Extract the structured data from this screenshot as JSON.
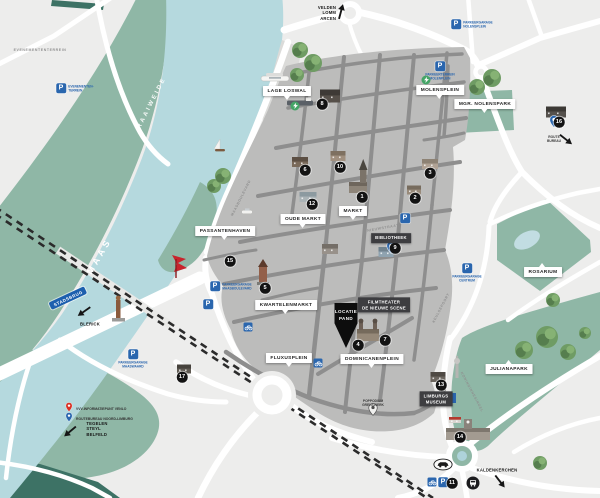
{
  "colors": {
    "water": "#b5d9de",
    "green": "#8fb7a6",
    "green_dark": "#3d7265",
    "city": "#bcbcbb",
    "street": "#8e8e8e",
    "road": "#ffffff",
    "bg": "#ededec",
    "marker": "#131313",
    "blue": "#2a66ae",
    "label_dark": "#3d3d40",
    "red_pin": "#d93025",
    "sculpture_red": "#c8242c"
  },
  "region_labels": [
    {
      "text": "RAAIWEIDE",
      "x": 152,
      "y": 103,
      "rot": -63,
      "size": 6,
      "ls": 2.5,
      "weight": "bold",
      "opacity": 0.95
    },
    {
      "text": "MAAS",
      "x": 99,
      "y": 256,
      "rot": -60,
      "size": 9,
      "ls": 3.5,
      "weight": "bold",
      "opacity": 1
    }
  ],
  "street_names": [
    {
      "text": "MAASBOULEVARD",
      "x": 241,
      "y": 198,
      "rot": -63
    },
    {
      "text": "NIEUWSTRAAT",
      "x": 383,
      "y": 228,
      "rot": -10
    },
    {
      "text": "KEULSEPOORT",
      "x": 441,
      "y": 308,
      "rot": -62
    },
    {
      "text": "KONINGINNESINGEL",
      "x": 472,
      "y": 392,
      "rot": 62
    },
    {
      "text": "EVENEMENTENTERREIN",
      "x": 40,
      "y": 50,
      "rot": 0
    }
  ],
  "place_labels": [
    {
      "text": "LAGE LOSWAL",
      "x": 287,
      "y": 91,
      "pointer": "down"
    },
    {
      "text": "MOLENSPLEIN",
      "x": 440,
      "y": 90,
      "pointer": "down"
    },
    {
      "text": "MGR. NOLENSPARK",
      "x": 485,
      "y": 104,
      "pointer": "down"
    },
    {
      "text": "ROSARIUM",
      "x": 543,
      "y": 272,
      "pointer": "up"
    },
    {
      "text": "OUDE MARKT",
      "x": 303,
      "y": 219,
      "pointer": "down"
    },
    {
      "text": "MARKT",
      "x": 353,
      "y": 211,
      "pointer": "down"
    },
    {
      "text": "PASSANTENHAVEN",
      "x": 225,
      "y": 231,
      "pointer": "down"
    },
    {
      "text": "KWARTELENMARKT",
      "x": 286,
      "y": 305,
      "pointer": "down"
    },
    {
      "text": "FLUXUSPLEIN",
      "x": 289,
      "y": 358,
      "pointer": "down"
    },
    {
      "text": "DOMINICANENPLEIN",
      "x": 372,
      "y": 359,
      "pointer": "down"
    },
    {
      "text": "JULIANAPARK",
      "x": 509,
      "y": 369,
      "pointer": "up"
    }
  ],
  "dark_labels": [
    {
      "lines": [
        "BIBLIOTHEEK"
      ],
      "x": 391,
      "y": 238
    },
    {
      "lines": [
        "FILMTHEATER",
        "DE NIEUWE SCENE"
      ],
      "x": 384,
      "y": 305
    },
    {
      "lines": [
        "LIMBURGS",
        "MUSEUM"
      ],
      "x": 436,
      "y": 399
    }
  ],
  "location_marker": {
    "lines": [
      "LOCATIE",
      "PAND"
    ],
    "x": 346,
    "y": 303
  },
  "numbered_markers": [
    {
      "n": "8",
      "x": 322,
      "y": 104
    },
    {
      "n": "6",
      "x": 305,
      "y": 170
    },
    {
      "n": "10",
      "x": 340,
      "y": 167
    },
    {
      "n": "1",
      "x": 362,
      "y": 197
    },
    {
      "n": "12",
      "x": 312,
      "y": 204
    },
    {
      "n": "3",
      "x": 430,
      "y": 173
    },
    {
      "n": "2",
      "x": 415,
      "y": 198
    },
    {
      "n": "9",
      "x": 395,
      "y": 248
    },
    {
      "n": "15",
      "x": 230,
      "y": 261
    },
    {
      "n": "5",
      "x": 265,
      "y": 288
    },
    {
      "n": "4",
      "x": 358,
      "y": 345
    },
    {
      "n": "7",
      "x": 385,
      "y": 340
    },
    {
      "n": "16",
      "x": 559,
      "y": 122
    },
    {
      "n": "13",
      "x": 441,
      "y": 385
    },
    {
      "n": "14",
      "x": 460,
      "y": 437
    },
    {
      "n": "17",
      "x": 182,
      "y": 377
    },
    {
      "n": "11",
      "x": 452,
      "y": 483
    }
  ],
  "parkings": [
    {
      "lines": [
        "EVENEMENTEN-",
        "TERREIN"
      ],
      "x": 61,
      "y": 88,
      "side": "right"
    },
    {
      "lines": [
        "PARKEERGARAGE",
        "NOLENSPLEIN"
      ],
      "x": 456,
      "y": 24,
      "side": "right"
    },
    {
      "lines": [
        "PARKEERTERREIN",
        "MOLENPLEIN"
      ],
      "x": 440,
      "y": 66,
      "side": "below"
    },
    {
      "lines": [
        "PARKEERGARAGE",
        "MAASBOULEVARD"
      ],
      "x": 215,
      "y": 286,
      "side": "right"
    },
    {
      "lines": [],
      "x": 208,
      "y": 304,
      "side": "below"
    },
    {
      "lines": [],
      "x": 405,
      "y": 218,
      "side": "below"
    },
    {
      "lines": [
        "PARKEERGARAGE",
        "MAASWAARD"
      ],
      "x": 133,
      "y": 354,
      "side": "below"
    },
    {
      "lines": [
        "PARKEERGARAGE",
        "CENTRUM"
      ],
      "x": 467,
      "y": 268,
      "side": "below"
    },
    {
      "lines": [],
      "x": 443,
      "y": 482,
      "side": "below"
    }
  ],
  "bike_racks": [
    {
      "x": 248,
      "y": 327
    },
    {
      "x": 318,
      "y": 363
    },
    {
      "x": 432,
      "y": 482
    }
  ],
  "info_points": [
    {
      "x": 451,
      "y": 398
    }
  ],
  "bus_stops": [
    {
      "x": 473,
      "y": 483
    }
  ],
  "car_icons": [
    {
      "x": 443,
      "y": 467
    }
  ],
  "charging_points": [
    {
      "x": 295,
      "y": 106
    },
    {
      "x": 426,
      "y": 80
    }
  ],
  "pins": [
    {
      "color": "blue",
      "x": 391,
      "y": 259,
      "label_lines": [],
      "label_pos": "below"
    },
    {
      "color": "blue",
      "x": 554,
      "y": 133,
      "label_lines": [
        "ROUTE",
        "BUREAU"
      ],
      "label_pos": "below",
      "arrow": {
        "x": 566,
        "y": 140,
        "rot": 38
      }
    },
    {
      "color": "gray",
      "x": 373,
      "y": 421,
      "label_lines": [
        "POPPODIUM",
        "GRENSWERK"
      ],
      "label_pos": "above"
    }
  ],
  "legend": {
    "x": 64,
    "y": 400,
    "rows": [
      {
        "pin": "red",
        "text": "VVV-INFORMATIEPUNT VENLO"
      },
      {
        "pin": "blue",
        "text": "ROUTEBUREAU NOORD-LIMBURG"
      }
    ]
  },
  "directions": [
    {
      "lines": [
        "VELDEN",
        "LOMM",
        "ARCEN"
      ],
      "x": 327,
      "y": 13,
      "align": "right",
      "arrow": {
        "x": 341,
        "y": 12,
        "rot": -75
      }
    },
    {
      "lines": [
        "BLERICK"
      ],
      "x": 90,
      "y": 324,
      "align": "left",
      "arrow": {
        "x": 84,
        "y": 312,
        "rot": 145
      }
    },
    {
      "lines": [
        "TEGELEN",
        "STEYL",
        "BELFELD"
      ],
      "x": 97,
      "y": 429,
      "align": "left",
      "arrow": {
        "x": 70,
        "y": 432,
        "rot": 140
      }
    },
    {
      "lines": [
        "KALDENKERCHEN"
      ],
      "x": 497,
      "y": 470,
      "align": "left",
      "arrow": {
        "x": 500,
        "y": 482,
        "rot": 52
      }
    }
  ],
  "road_signs": [
    {
      "text": "STADSBRUG",
      "x": 68,
      "y": 298
    }
  ],
  "trees": [
    {
      "x": 300,
      "y": 50,
      "r": 8
    },
    {
      "x": 313,
      "y": 63,
      "r": 9
    },
    {
      "x": 297,
      "y": 75,
      "r": 7
    },
    {
      "x": 214,
      "y": 186,
      "r": 7
    },
    {
      "x": 223,
      "y": 176,
      "r": 8
    },
    {
      "x": 477,
      "y": 87,
      "r": 8
    },
    {
      "x": 492,
      "y": 78,
      "r": 9
    },
    {
      "x": 524,
      "y": 350,
      "r": 9
    },
    {
      "x": 547,
      "y": 337,
      "r": 11
    },
    {
      "x": 568,
      "y": 352,
      "r": 8
    },
    {
      "x": 553,
      "y": 300,
      "r": 7
    },
    {
      "x": 585,
      "y": 333,
      "r": 6
    },
    {
      "x": 540,
      "y": 463,
      "r": 7
    }
  ],
  "boats": [
    {
      "x": 275,
      "y": 78,
      "type": "cruise"
    },
    {
      "x": 300,
      "y": 103,
      "type": "barge"
    },
    {
      "x": 220,
      "y": 150,
      "type": "sail"
    },
    {
      "x": 247,
      "y": 212,
      "type": "small"
    }
  ],
  "monuments": [
    {
      "type": "statue",
      "x": 118,
      "y": 306
    },
    {
      "type": "red-sculpture",
      "x": 172,
      "y": 255
    },
    {
      "type": "tv-tower",
      "x": 457,
      "y": 358
    }
  ],
  "buildings": [
    {
      "x": 330,
      "y": 96,
      "w": 20,
      "h": 13,
      "c": "#56504a",
      "rc": "#3e3a36",
      "type": "house"
    },
    {
      "x": 300,
      "y": 162,
      "w": 16,
      "h": 10,
      "c": "#7a6a5a",
      "rc": "#5c4f43",
      "type": "house"
    },
    {
      "x": 338,
      "y": 156,
      "w": 15,
      "h": 10,
      "c": "#a08f7e",
      "rc": "#7e7060",
      "type": "house"
    },
    {
      "x": 358,
      "y": 186,
      "type": "church1"
    },
    {
      "x": 308,
      "y": 197,
      "w": 17,
      "h": 10,
      "c": "#aab3b6",
      "rc": "#8c9aa0",
      "type": "house"
    },
    {
      "x": 430,
      "y": 164,
      "w": 16,
      "h": 10,
      "c": "#b0a294",
      "rc": "#8d8274",
      "type": "house"
    },
    {
      "x": 414,
      "y": 190,
      "w": 14,
      "h": 9,
      "c": "#988a7a",
      "rc": "#776c5e",
      "type": "house"
    },
    {
      "x": 386,
      "y": 252,
      "w": 15,
      "h": 10,
      "c": "#8fa3b0",
      "rc": "#70828e",
      "type": "house"
    },
    {
      "x": 263,
      "y": 279,
      "type": "tower"
    },
    {
      "x": 368,
      "y": 334,
      "type": "church2"
    },
    {
      "x": 556,
      "y": 112,
      "w": 20,
      "h": 11,
      "c": "#55514c",
      "rc": "#3c3935",
      "type": "house"
    },
    {
      "x": 438,
      "y": 377,
      "w": 15,
      "h": 10,
      "c": "#6b655e",
      "rc": "#4f4a44",
      "type": "house"
    },
    {
      "x": 468,
      "y": 434,
      "type": "station"
    },
    {
      "x": 184,
      "y": 369,
      "w": 14,
      "h": 9,
      "c": "#5f5a52",
      "rc": "#46423c",
      "type": "house"
    },
    {
      "x": 455,
      "y": 420,
      "w": 12,
      "h": 6,
      "c": "#d8d4cf",
      "rc": "#b33a2e",
      "type": "house"
    },
    {
      "x": 330,
      "y": 249,
      "w": 16,
      "h": 10,
      "c": "#98918a",
      "rc": "#746e67",
      "type": "house"
    }
  ]
}
